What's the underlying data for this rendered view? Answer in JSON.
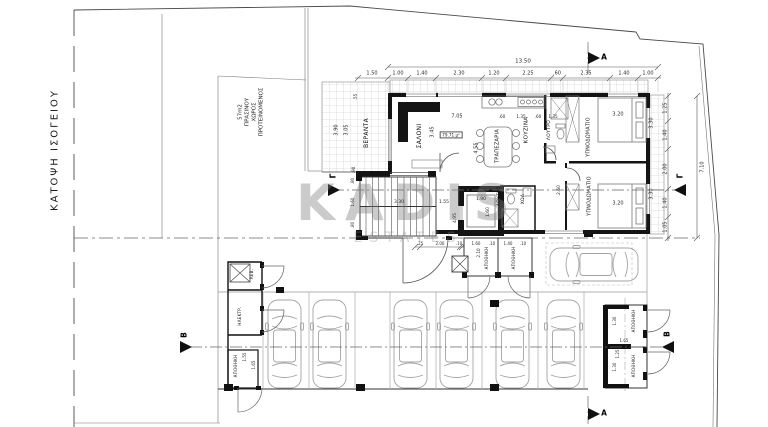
{
  "title": {
    "text": "ΚΑΤΟΨΗ ΙΣΟΓΕΙΟΥ"
  },
  "watermark": {
    "main": "KADIS",
    "sub": "ESTATES"
  },
  "colors": {
    "wall": "#141414",
    "thin_line": "#555555",
    "tile": "#c4c4c4",
    "watermark": "#7d7d7d"
  },
  "annotations": [
    {
      "t": "ΠΡΟΤΕΙΝΟΜΕΝΟΣ",
      "x": 262,
      "y": 112,
      "r": -90,
      "s": 5.5,
      "n": "green-space-label"
    },
    {
      "t": "ΧΩΡΟΣ",
      "x": 255,
      "y": 112,
      "r": -90,
      "s": 5.5,
      "n": "green-space-label"
    },
    {
      "t": "ΠΡΑΣΙΝΟΥ",
      "x": 248,
      "y": 112,
      "r": -90,
      "s": 5.5,
      "n": "green-space-label"
    },
    {
      "t": "57m2",
      "x": 241,
      "y": 112,
      "r": -90,
      "s": 5.5,
      "n": "green-space-label"
    },
    {
      "t": "13.50",
      "x": 523,
      "y": 62,
      "s": 5.5
    },
    {
      "t": "1.50",
      "x": 372,
      "y": 74,
      "s": 5
    },
    {
      "t": "1.00",
      "x": 398,
      "y": 74,
      "s": 5
    },
    {
      "t": "1.40",
      "x": 422,
      "y": 74,
      "s": 5
    },
    {
      "t": "2.30",
      "x": 459,
      "y": 74,
      "s": 5
    },
    {
      "t": "1.20",
      "x": 494,
      "y": 74,
      "s": 5
    },
    {
      "t": "2.25",
      "x": 528,
      "y": 74,
      "s": 5
    },
    {
      "t": ".60",
      "x": 557,
      "y": 74,
      "s": 5
    },
    {
      "t": "2.35",
      "x": 586,
      "y": 74,
      "s": 5
    },
    {
      "t": "1.40",
      "x": 624,
      "y": 74,
      "s": 5
    },
    {
      "t": "1.00",
      "x": 648,
      "y": 74,
      "s": 5
    },
    {
      "t": "1.25",
      "x": 666,
      "y": 108,
      "r": -90,
      "s": 5
    },
    {
      "t": "1.40",
      "x": 666,
      "y": 135,
      "r": -90,
      "s": 5
    },
    {
      "t": "2.00",
      "x": 666,
      "y": 169,
      "r": -90,
      "s": 5
    },
    {
      "t": "1.40",
      "x": 666,
      "y": 203,
      "r": -90,
      "s": 5
    },
    {
      "t": "1.05",
      "x": 666,
      "y": 227,
      "r": -90,
      "s": 5
    },
    {
      "t": "7.10",
      "x": 703,
      "y": 167,
      "r": -90,
      "s": 5
    },
    {
      "t": "ΒΕΡΑΝΤΑ",
      "x": 367,
      "y": 133,
      "r": -90,
      "s": 6,
      "c": "room",
      "n": "room-label-veranda"
    },
    {
      "t": "3.90",
      "x": 337,
      "y": 130,
      "r": -90,
      "s": 5
    },
    {
      "t": "3.05",
      "x": 347,
      "y": 130,
      "r": -90,
      "s": 5
    },
    {
      "t": ".55",
      "x": 356,
      "y": 97,
      "r": -90,
      "s": 4.2
    },
    {
      "t": ".90",
      "x": 354,
      "y": 170,
      "r": -90,
      "s": 4.2
    },
    {
      "t": "ΣΑΛΟΝΙ",
      "x": 420,
      "y": 136,
      "r": -90,
      "s": 6,
      "c": "room",
      "n": "room-label-living"
    },
    {
      "t": "3.45",
      "x": 433,
      "y": 132,
      "r": -90,
      "s": 5
    },
    {
      "t": "7.05",
      "x": 457,
      "y": 117,
      "s": 5
    },
    {
      "t": "79.71 μ²",
      "x": 451,
      "y": 135,
      "s": 4.2,
      "c": "boxed",
      "n": "area-label"
    },
    {
      "t": "ΤΡΑΠΕΖΑΡΙΑ",
      "x": 498,
      "y": 146,
      "r": -90,
      "s": 5,
      "c": "room",
      "n": "room-label-dining"
    },
    {
      "t": "4.55",
      "x": 477,
      "y": 148,
      "r": -90,
      "s": 5
    },
    {
      "t": "ΚΟΥΖΙΝΑ",
      "x": 527,
      "y": 130,
      "r": -90,
      "s": 5.5,
      "c": "room",
      "n": "room-label-kitchen"
    },
    {
      "t": ".60",
      "x": 502,
      "y": 117,
      "s": 4.2
    },
    {
      "t": "1.35",
      "x": 521,
      "y": 117,
      "s": 4.2
    },
    {
      "t": ".60",
      "x": 538,
      "y": 117,
      "s": 4.2
    },
    {
      "t": "1.35",
      "x": 553,
      "y": 117,
      "s": 4.2
    },
    {
      "t": "ΛΟΥΤΡΟ",
      "x": 550,
      "y": 130,
      "r": -90,
      "s": 4.5,
      "c": "room",
      "n": "room-label-bath"
    },
    {
      "t": "ΥΠΝΟΔΩΜΑΤΙΟ",
      "x": 590,
      "y": 137,
      "r": -90,
      "s": 4.8,
      "c": "room",
      "n": "room-label-bedroom"
    },
    {
      "t": "3.20",
      "x": 618,
      "y": 115,
      "s": 5
    },
    {
      "t": "3.30",
      "x": 652,
      "y": 123,
      "r": -90,
      "s": 5
    },
    {
      "t": "ΥΠΝΟΔΩΜΑΤΙΟ",
      "x": 591,
      "y": 196,
      "r": -90,
      "s": 4.8,
      "c": "room",
      "n": "room-label-bedroom"
    },
    {
      "t": "3.20",
      "x": 618,
      "y": 204,
      "s": 5
    },
    {
      "t": "3.30",
      "x": 652,
      "y": 194,
      "r": -90,
      "s": 5
    },
    {
      "t": "2.60",
      "x": 560,
      "y": 190,
      "r": -90,
      "s": 4.5
    },
    {
      "t": "ΧΩΛ",
      "x": 524,
      "y": 199,
      "r": -90,
      "s": 4.5,
      "c": "room",
      "n": "room-label-hall"
    },
    {
      "t": "ΛΟΥΤΡΟ",
      "x": 500,
      "y": 196,
      "r": -90,
      "s": 4.5,
      "c": "room",
      "n": "room-label-bath"
    },
    {
      "t": "3.30",
      "x": 399,
      "y": 203,
      "s": 4.5
    },
    {
      "t": "1.55",
      "x": 444,
      "y": 203,
      "s": 4.5
    },
    {
      "t": "4.95",
      "x": 456,
      "y": 218,
      "r": -90,
      "s": 4.5
    },
    {
      "t": ".80",
      "x": 353,
      "y": 181,
      "r": -90,
      "s": 4
    },
    {
      "t": "1.60",
      "x": 353,
      "y": 202,
      "r": -90,
      "s": 4
    },
    {
      "t": ".80",
      "x": 353,
      "y": 225,
      "r": -90,
      "s": 4
    },
    {
      "t": "1.90",
      "x": 481,
      "y": 200,
      "s": 4.5
    },
    {
      "t": "1.60",
      "x": 489,
      "y": 212,
      "r": -90,
      "s": 4.5
    },
    {
      "t": ".25",
      "x": 420,
      "y": 244,
      "s": 4
    },
    {
      "t": "2.00",
      "x": 440,
      "y": 244,
      "s": 4
    },
    {
      "t": ".10",
      "x": 459,
      "y": 244,
      "s": 4
    },
    {
      "t": "1.60",
      "x": 476,
      "y": 244,
      "s": 4
    },
    {
      "t": ".10",
      "x": 492,
      "y": 244,
      "s": 4
    },
    {
      "t": "1.40",
      "x": 508,
      "y": 244,
      "s": 4
    },
    {
      "t": ".10",
      "x": 523,
      "y": 244,
      "s": 4
    },
    {
      "t": "2.10",
      "x": 479,
      "y": 253,
      "r": -90,
      "s": 4.2
    },
    {
      "t": "ΑΠΟΘΗΚΗ",
      "x": 487,
      "y": 258,
      "r": -90,
      "s": 4,
      "c": "room",
      "n": "room-label-storage"
    },
    {
      "t": "ΑΠΟΘΗΚΗ",
      "x": 514,
      "y": 258,
      "r": -90,
      "s": 4,
      "c": "room",
      "n": "room-label-storage"
    },
    {
      "t": "ΛΕΒ.",
      "x": 252,
      "y": 274,
      "r": -90,
      "s": 4,
      "c": "room",
      "n": "room-label-boiler"
    },
    {
      "t": "ΗΛΕΚΤΡ.",
      "x": 240,
      "y": 316,
      "r": -90,
      "s": 4,
      "c": "room",
      "n": "room-label-electrical"
    },
    {
      "t": "ΑΠΟΘΗΚΗ",
      "x": 236,
      "y": 366,
      "r": -90,
      "s": 4,
      "c": "room",
      "n": "room-label-storage"
    },
    {
      "t": "1.55",
      "x": 245,
      "y": 357,
      "r": -90,
      "s": 4
    },
    {
      "t": "1.65",
      "x": 254,
      "y": 365,
      "r": -90,
      "s": 4
    },
    {
      "t": "ΑΠΟΘΗΚΗ",
      "x": 634,
      "y": 321,
      "r": -90,
      "s": 4,
      "c": "room",
      "n": "room-label-storage"
    },
    {
      "t": "ΑΠΟΘΗΚΗ",
      "x": 634,
      "y": 366,
      "r": -90,
      "s": 4,
      "c": "room",
      "n": "room-label-storage"
    },
    {
      "t": "1.30",
      "x": 615,
      "y": 321,
      "r": -90,
      "s": 4
    },
    {
      "t": "1.65",
      "x": 624,
      "y": 341,
      "s": 4
    },
    {
      "t": "1.25",
      "x": 618,
      "y": 354,
      "r": -90,
      "s": 4
    },
    {
      "t": "1.30",
      "x": 615,
      "y": 367,
      "r": -90,
      "s": 4
    },
    {
      "t": "A",
      "x": 604,
      "y": 57,
      "s": 7.5,
      "c": "sec",
      "n": "section-letter-a"
    },
    {
      "t": "A",
      "x": 604,
      "y": 413,
      "s": 7.5,
      "c": "sec",
      "n": "section-letter-a"
    },
    {
      "t": "B",
      "x": 184,
      "y": 335,
      "r": -90,
      "s": 7.5,
      "c": "sec",
      "n": "section-letter-b"
    },
    {
      "t": "B",
      "x": 667,
      "y": 334,
      "r": -90,
      "s": 7.5,
      "c": "sec",
      "n": "section-letter-b"
    },
    {
      "t": "Γ",
      "x": 333,
      "y": 176,
      "r": -90,
      "s": 7.5,
      "c": "sec",
      "n": "section-letter-gamma"
    },
    {
      "t": "Γ",
      "x": 680,
      "y": 176,
      "r": -90,
      "s": 7.5,
      "c": "sec",
      "n": "section-letter-gamma"
    }
  ]
}
